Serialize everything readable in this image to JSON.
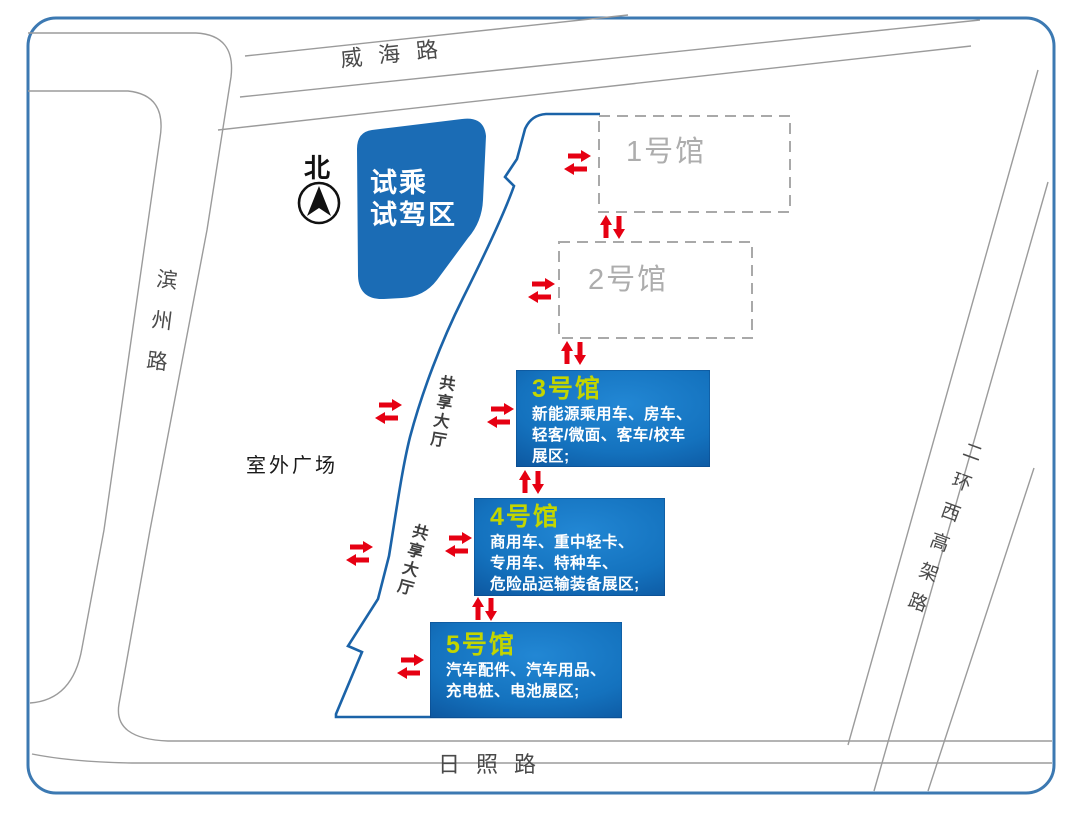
{
  "roads": {
    "top": "威海路",
    "left": "滨州路",
    "bottom": "日照路",
    "right": "二环西高架路"
  },
  "north": {
    "label": "北"
  },
  "test_drive_area": {
    "line1": "试乘",
    "line2": "试驾区"
  },
  "outdoor_plaza": {
    "label": "室外广场"
  },
  "shared_halls": {
    "upper": "共享大厅",
    "lower": "共享大厅"
  },
  "halls": [
    {
      "name": "1号馆",
      "style": "dashed"
    },
    {
      "name": "2号馆",
      "style": "dashed"
    },
    {
      "name": "3号馆",
      "style": "solid",
      "desc_lines": [
        "新能源乘用车、房车、",
        "轻客/微面、客车/校车",
        "展区;"
      ]
    },
    {
      "name": "4号馆",
      "style": "solid",
      "desc_lines": [
        "商用车、重中轻卡、",
        "专用车、特种车、",
        "危险品运输装备展区;"
      ]
    },
    {
      "name": "5号馆",
      "style": "solid",
      "desc_lines": [
        "汽车配件、汽车用品、",
        "充电桩、电池展区;"
      ]
    }
  ],
  "colors": {
    "frame_blue": "#3c79b2",
    "boundary_blue": "#1b63a8",
    "area_blue": "#1b6cb5",
    "hall_title_yellow": "#c3d500",
    "arrow_red": "#e60012",
    "road_gray": "#9b9b9b",
    "dashed_gray": "#a9a9a9"
  }
}
